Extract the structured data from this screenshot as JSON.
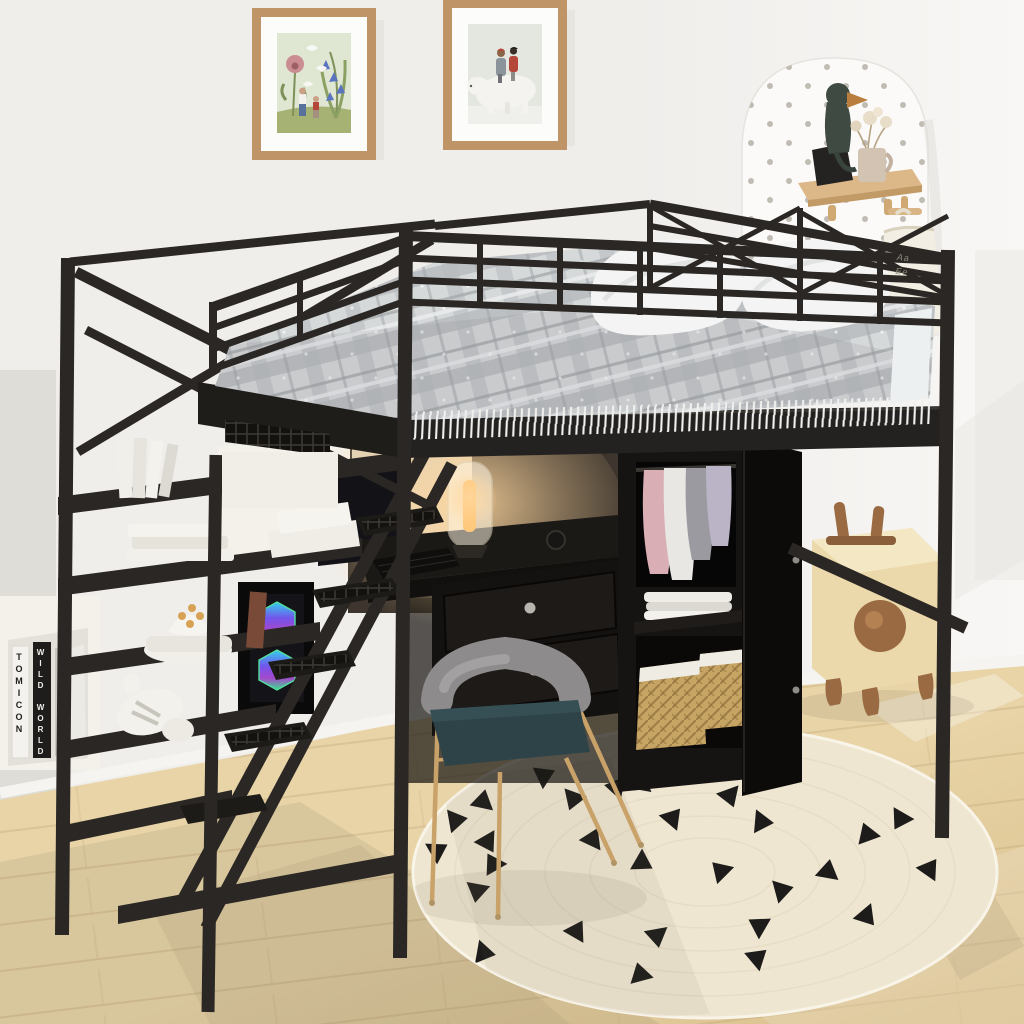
{
  "meta": {
    "kind": "product-photo-render",
    "subject": "Black metal full-size loft bed with storage staircase, desk, wardrobe and shelves in a kids room"
  },
  "texts": {
    "book_spine_white": "TOMICON",
    "book_spine_black": "WILD WORLD",
    "bag_line_1": "Aa",
    "bag_line_2": "Ee"
  },
  "palette": {
    "wall": "#f0eeeb",
    "wall_bright": "#f8f7f5",
    "wall_shade": "#dbd9d5",
    "floor": "#e8d4a7",
    "floor_dark": "#d9bf8c",
    "plank_line": "#c3a87a",
    "baseboard": "#f5f4f1",
    "rug": "#efe6d1",
    "rug_ring": "#d9cdb2",
    "triangle": "#1d1c1a",
    "metal": "#2a2724",
    "metal_light": "#403c36",
    "bedding": "#d6d9da",
    "bedding_band": "#b6babd",
    "bedding_line": "#9fa4a7",
    "mattress_side": "#edf0f1",
    "pillow": "#f3f4f3",
    "fringe": "#f0f0ee",
    "frame_wood": "#bf9568",
    "mat": "#fcfcfa",
    "art1_bg": "#dfe6d2",
    "art1_ground": "#a6b273",
    "art1_poppy": "#cb8d92",
    "art1_bell": "#5b74c0",
    "art2_bg": "#e4e7e0",
    "art2_bear": "#f4f3ef",
    "art2_coat_red": "#b4473a",
    "art2_coat_grey": "#8b949b",
    "pegboard": "#fbfaf8",
    "peg_dot": "#b6b1a8",
    "shelf_wood": "#dcb888",
    "bird_body": "#3e4a42",
    "bird_beak": "#b97e3e",
    "stone": "#242322",
    "mug": "#d3c3b2",
    "glow": "#ffd79e",
    "desk": "#1b1916",
    "drawer": "#141210",
    "knob": "#b9b5ae",
    "chair_gold": "#c9a26a",
    "chair_back": "#8e8b8c",
    "chair_seat": "#2e4347",
    "wicker": "#c6a463",
    "wicker_line": "#8a6a38",
    "liner": "#efece4",
    "wood_toy": "#ecd9ab",
    "wood_toy_light": "#f4e7c4",
    "walnut": "#9a6b43",
    "cloth_pink": "#d9aeb4",
    "cloth_grey": "#9b9aa0",
    "cloth_white": "#e9e7e3",
    "cloth_lav": "#bab4c6",
    "bag": "#f2eee3",
    "white_furniture": "#f4f1ea",
    "pc_body": "#0b0a0a"
  },
  "objects": [
    "framed-art-flowers-and-birds",
    "framed-art-kids-on-polar-bear",
    "arched-pegboard-with-wall-shelf",
    "wooden-bird-figurine",
    "dried-flower-mug",
    "canvas-alphabet-bag",
    "black-metal-loft-bed",
    "grey-plaid-comforter-with-fringe",
    "two-white-pillows",
    "storage-staircase-with-shelves",
    "white-cube-bookshelf",
    "desk-with-lamp-and-drawers",
    "gaming-pc-with-rgb-fans",
    "gold-frame-chair-teal-seat",
    "black-wardrobe-with-clothes",
    "wicker-baskets",
    "wooden-rabbit-stool",
    "round-jute-rug-with-black-triangles",
    "light-wood-floor"
  ]
}
